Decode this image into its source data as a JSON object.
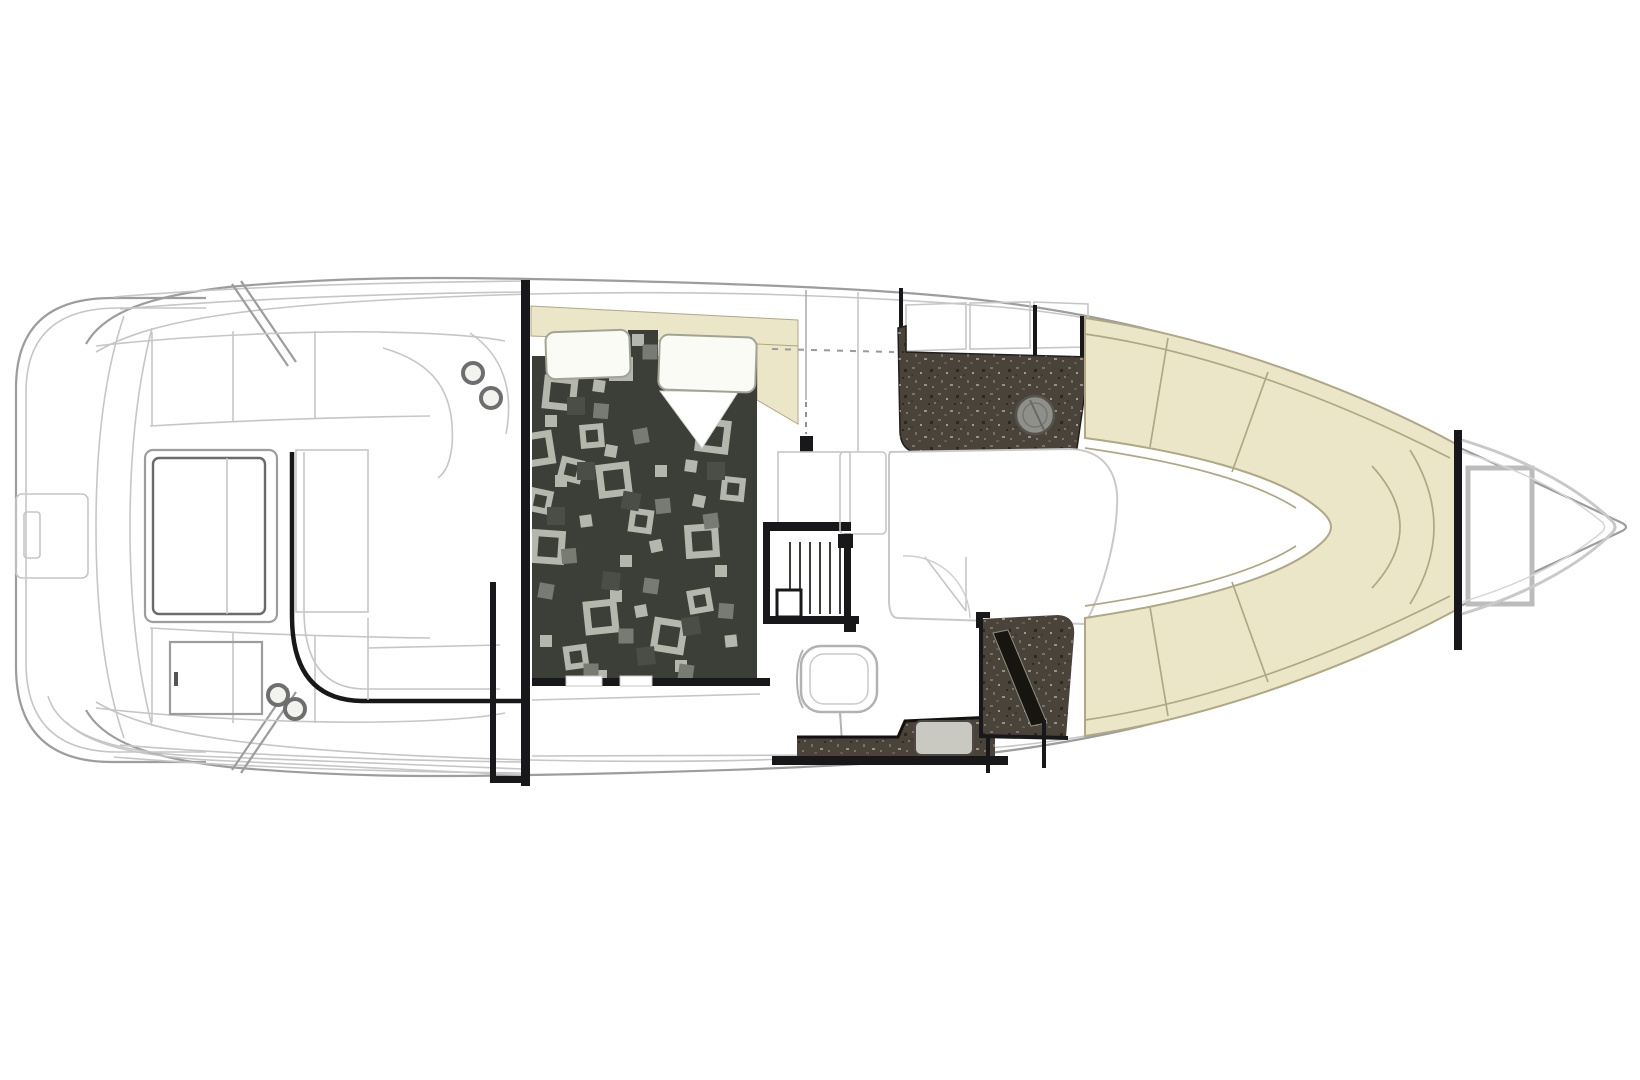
{
  "window": {
    "title": "Boat floor plan diagram",
    "description": "Top-down yacht interior arrangement line drawing: swim platform and cockpit aft, mid-cabin berth, galley, head and bow lounge forward"
  },
  "colors": {
    "background": "#ffffff",
    "line_light": "#c6c6c6",
    "line_mid": "#9d9d9d",
    "line_dark": "#6a6a6a",
    "wall_black": "#18181a",
    "cream_fill": "#ece6c9",
    "cream_line": "#b0a784",
    "spread_base": "#3c3f38",
    "spread_sq_light": "#b3b7ac",
    "spread_sq_mid": "#777b71",
    "spread_sq_ghost": "#4b4e46",
    "counter_dark": "#494339",
    "counter_fleck": "#8a8274",
    "shower_band": "#16150f",
    "sink_metal": "#90908a",
    "sink_light": "#c9c9c1",
    "pillow_fill": "#fbfbf5",
    "pillow_line": "#a3a395",
    "cup_ring": "#6e6e6e"
  },
  "regions": [
    {
      "id": "swim-platform",
      "kind": "exterior-deck"
    },
    {
      "id": "cockpit",
      "kind": "seating-helm"
    },
    {
      "id": "mid-cabin-berth",
      "kind": "bed"
    },
    {
      "id": "companionway-stairs",
      "kind": "stairs"
    },
    {
      "id": "galley",
      "kind": "counter-sink"
    },
    {
      "id": "mid-lounge",
      "kind": "seating"
    },
    {
      "id": "head",
      "kind": "toilet-vanity-shower"
    },
    {
      "id": "bow-lounge",
      "kind": "u-shaped-seating"
    },
    {
      "id": "anchor-locker",
      "kind": "storage"
    }
  ],
  "bed": {
    "squares": [
      {
        "x": 560,
        "y": 393,
        "t": "L",
        "r": 6
      },
      {
        "x": 614,
        "y": 480,
        "t": "L",
        "r": -7
      },
      {
        "x": 548,
        "y": 547,
        "t": "L",
        "r": 4
      },
      {
        "x": 601,
        "y": 617,
        "t": "L",
        "r": -6
      },
      {
        "x": 669,
        "y": 636,
        "t": "L",
        "r": 9
      },
      {
        "x": 702,
        "y": 541,
        "t": "L",
        "r": -4
      },
      {
        "x": 713,
        "y": 436,
        "t": "L",
        "r": 7
      },
      {
        "x": 537,
        "y": 449,
        "t": "L",
        "r": -9
      },
      {
        "x": 592,
        "y": 436,
        "t": "M",
        "r": -5
      },
      {
        "x": 641,
        "y": 521,
        "t": "M",
        "r": 8
      },
      {
        "x": 576,
        "y": 657,
        "t": "M",
        "r": -8
      },
      {
        "x": 700,
        "y": 601,
        "t": "M",
        "r": -10
      },
      {
        "x": 733,
        "y": 489,
        "t": "M",
        "r": 6
      },
      {
        "x": 540,
        "y": 501,
        "t": "M",
        "r": 12
      },
      {
        "x": 621,
        "y": 369,
        "t": "M",
        "r": 0
      },
      {
        "x": 571,
        "y": 470,
        "t": "M",
        "r": 14
      },
      {
        "x": 551,
        "y": 421,
        "t": "s",
        "r": 0
      },
      {
        "x": 611,
        "y": 451,
        "t": "s",
        "r": 10
      },
      {
        "x": 661,
        "y": 471,
        "t": "s",
        "r": 0
      },
      {
        "x": 586,
        "y": 521,
        "t": "s",
        "r": -8
      },
      {
        "x": 626,
        "y": 561,
        "t": "s",
        "r": 0
      },
      {
        "x": 699,
        "y": 501,
        "t": "s",
        "r": 12
      },
      {
        "x": 546,
        "y": 641,
        "t": "s",
        "r": 0
      },
      {
        "x": 641,
        "y": 611,
        "t": "s",
        "r": -10
      },
      {
        "x": 721,
        "y": 571,
        "t": "s",
        "r": 0
      },
      {
        "x": 599,
        "y": 386,
        "t": "s",
        "r": 8
      },
      {
        "x": 681,
        "y": 666,
        "t": "s",
        "r": 0
      },
      {
        "x": 731,
        "y": 641,
        "t": "s",
        "r": -6
      },
      {
        "x": 561,
        "y": 481,
        "t": "s",
        "r": 0
      },
      {
        "x": 691,
        "y": 466,
        "t": "s",
        "r": 8
      },
      {
        "x": 616,
        "y": 596,
        "t": "s",
        "r": 0
      },
      {
        "x": 656,
        "y": 546,
        "t": "s",
        "r": -12
      },
      {
        "x": 638,
        "y": 340,
        "t": "s",
        "r": 0
      },
      {
        "x": 601,
        "y": 676,
        "t": "s",
        "r": 0
      },
      {
        "x": 601,
        "y": 411,
        "t": "m",
        "r": 5
      },
      {
        "x": 569,
        "y": 556,
        "t": "m",
        "r": -5
      },
      {
        "x": 651,
        "y": 586,
        "t": "m",
        "r": 8
      },
      {
        "x": 711,
        "y": 521,
        "t": "m",
        "r": -8
      },
      {
        "x": 626,
        "y": 636,
        "t": "m",
        "r": 0
      },
      {
        "x": 546,
        "y": 591,
        "t": "m",
        "r": 10
      },
      {
        "x": 641,
        "y": 436,
        "t": "m",
        "r": -10
      },
      {
        "x": 726,
        "y": 611,
        "t": "m",
        "r": 5
      },
      {
        "x": 591,
        "y": 671,
        "t": "m",
        "r": 0
      },
      {
        "x": 663,
        "y": 506,
        "t": "m",
        "r": -6
      },
      {
        "x": 650,
        "y": 352,
        "t": "m",
        "r": 0
      },
      {
        "x": 686,
        "y": 672,
        "t": "m",
        "r": 8
      },
      {
        "x": 586,
        "y": 471,
        "t": "g",
        "r": 0
      },
      {
        "x": 631,
        "y": 501,
        "t": "g",
        "r": 10
      },
      {
        "x": 556,
        "y": 516,
        "t": "g",
        "r": 0
      },
      {
        "x": 691,
        "y": 626,
        "t": "g",
        "r": -8
      },
      {
        "x": 716,
        "y": 471,
        "t": "g",
        "r": 0
      },
      {
        "x": 611,
        "y": 581,
        "t": "g",
        "r": 6
      },
      {
        "x": 576,
        "y": 406,
        "t": "g",
        "r": 0
      },
      {
        "x": 646,
        "y": 656,
        "t": "g",
        "r": -6
      }
    ]
  }
}
